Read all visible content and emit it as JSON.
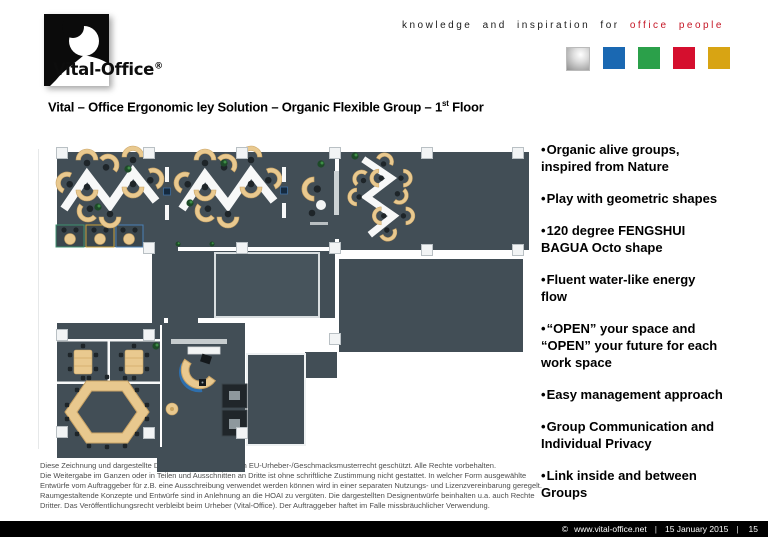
{
  "brand": {
    "logo_text": "Vital-Office",
    "logo_reg": "®",
    "tagline_black": "knowledge and inspiration for",
    "tagline_red": "office people",
    "squares": [
      {
        "name": "silver",
        "style": "background:radial-gradient(circle at 62% 30%, #ffffff 0%, #dedede 35%, #8f8f8f 100%);border:1px solid #bbbbbb"
      },
      {
        "name": "blue",
        "style": "background:#1a68b2"
      },
      {
        "name": "green",
        "style": "background:#2ba04a"
      },
      {
        "name": "red",
        "style": "background:#d50f2e"
      },
      {
        "name": "gold",
        "style": "background:#d8a413"
      }
    ]
  },
  "title": {
    "part1": "Vital – Office Ergonomic ley Solution – Organic Flexible Group – 1",
    "sup": "st",
    "part2": " Floor"
  },
  "bullets": [
    {
      "lines": [
        "Organic alive groups,",
        "inspired from Nature"
      ]
    },
    {
      "lines": [
        "Play with geometric shapes"
      ]
    },
    {
      "lines": [
        "120 degree FENGSHUI",
        "BAGUA Octo shape"
      ]
    },
    {
      "lines": [
        "Fluent water-like energy",
        "flow"
      ]
    },
    {
      "lines": [
        "“OPEN” your space and",
        "“OPEN” your future for each",
        "work space"
      ]
    },
    {
      "lines": [
        "Easy management approach"
      ]
    },
    {
      "lines": [
        "Group Communication and",
        "Individual Privacy"
      ]
    },
    {
      "lines": [
        "Link inside and between",
        "Groups"
      ]
    }
  ],
  "legal_lines": [
    "Diese Zeichnung und dargestellte Designs/Entwürfe sind nach EU-Urheber-/Geschmacksmusterrecht geschützt. Alle Rechte vorbehalten.",
    "Die Weitergabe im Ganzen oder in Teilen und Ausschnitten an Dritte ist ohne schriftliche Zustimmung nicht gestattet. In welcher Form ausgewählte",
    "Entwürfe vom Auftraggeber für z.B. eine Ausschreibung verwendet werden können wird in einer separaten Nutzungs- und Lizenzvereinbarung geregelt.",
    "Raumgestaltende Konzepte und Entwürfe sind in Anlehnung an die HOAI zu vergüten. Die dargestellten Designentwürfe beinhalten u.a. auch Rechte",
    "Dritter. Das Veröffentlichungsrecht verbleibt beim Urheber (Vital-Office). Der Auftraggeber haftet im Falle missbräuchlicher Verwendung."
  ],
  "footer": {
    "copyright": "©",
    "url": "www.vital-office.net",
    "sep1": "|",
    "date": "15 January 2015",
    "sep2": "|",
    "page": "15"
  },
  "colors": {
    "floor": "#424e56",
    "desk_wood": "#e9c98f",
    "wall_white": "#f7f8f8",
    "accent_red": "#c51625"
  }
}
